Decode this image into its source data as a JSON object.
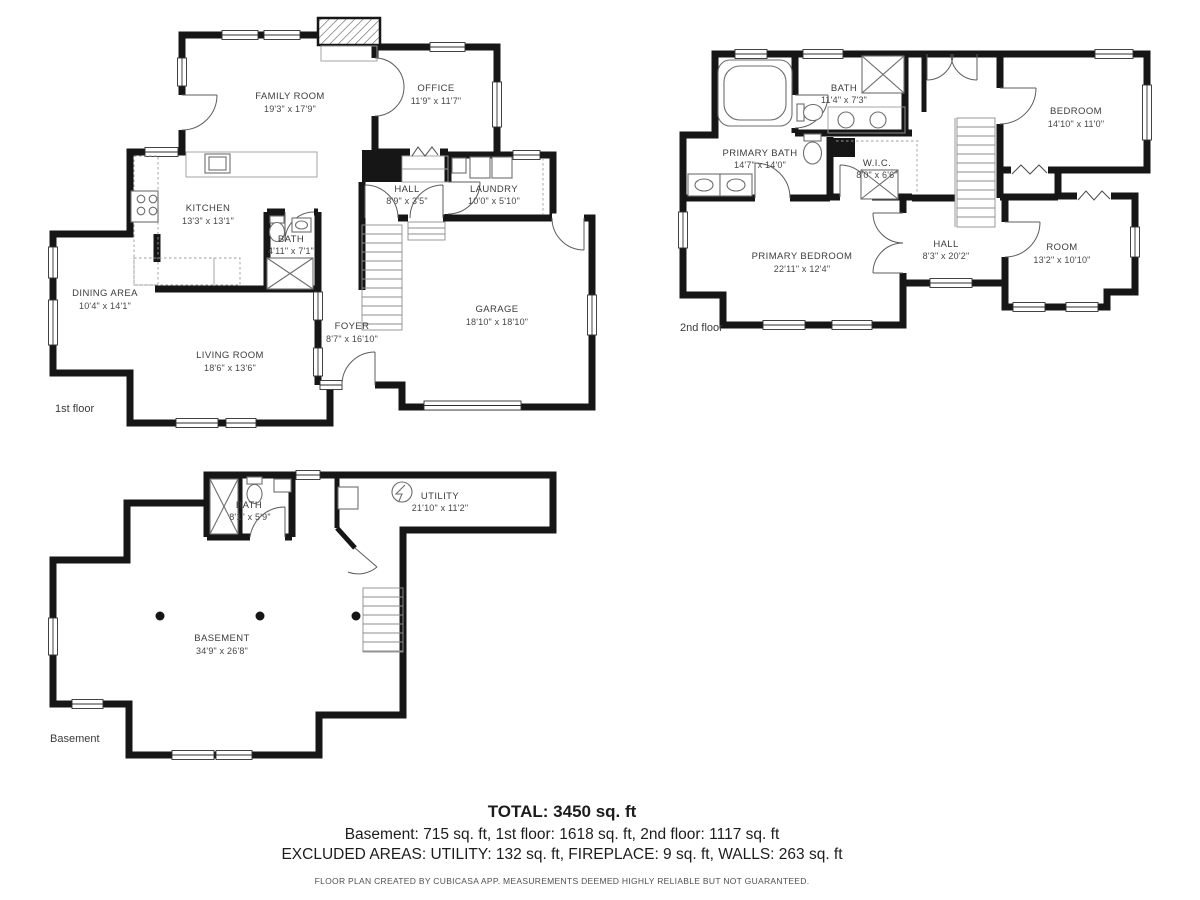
{
  "colors": {
    "wall": "#161616",
    "background": "#ffffff",
    "label_text": "#3c3c3c"
  },
  "floors": {
    "first": {
      "label": "1st floor",
      "rooms": [
        {
          "name": "FAMILY ROOM",
          "dims": "19'3\" x 17'9\""
        },
        {
          "name": "OFFICE",
          "dims": "11'9\" x 11'7\""
        },
        {
          "name": "KITCHEN",
          "dims": "13'3\" x 13'1\""
        },
        {
          "name": "HALL",
          "dims": "8'9\" x 3'5\""
        },
        {
          "name": "LAUNDRY",
          "dims": "10'0\" x 5'10\""
        },
        {
          "name": "BATH",
          "dims": "4'11\" x 7'1\""
        },
        {
          "name": "DINING AREA",
          "dims": "10'4\" x 14'1\""
        },
        {
          "name": "LIVING ROOM",
          "dims": "18'6\" x 13'6\""
        },
        {
          "name": "FOYER",
          "dims": "8'7\" x 16'10\""
        },
        {
          "name": "GARAGE",
          "dims": "18'10\" x 18'10\""
        }
      ]
    },
    "second": {
      "label": "2nd floor",
      "rooms": [
        {
          "name": "BATH",
          "dims": "11'4\" x 7'3\""
        },
        {
          "name": "BEDROOM",
          "dims": "14'10\" x 11'0\""
        },
        {
          "name": "PRIMARY BATH",
          "dims": "14'7\" x 14'0\""
        },
        {
          "name": "W.I.C.",
          "dims": "8'0\" x 6'6\""
        },
        {
          "name": "HALL",
          "dims": "8'3\" x 20'2\""
        },
        {
          "name": "PRIMARY BEDROOM",
          "dims": "22'11\" x 12'4\""
        },
        {
          "name": "ROOM",
          "dims": "13'2\" x 10'10\""
        }
      ]
    },
    "basement": {
      "label": "Basement",
      "rooms": [
        {
          "name": "BATH",
          "dims": "8'1\" x 5'9\""
        },
        {
          "name": "UTILITY",
          "dims": "21'10\" x 11'2\""
        },
        {
          "name": "BASEMENT",
          "dims": "34'9\" x 26'8\""
        }
      ]
    }
  },
  "footer": {
    "total": "TOTAL: 3450 sq. ft",
    "areas": "Basement: 715 sq. ft, 1st floor: 1618 sq. ft, 2nd floor: 1117 sq. ft",
    "excluded": "EXCLUDED AREAS: UTILITY: 132 sq. ft, FIREPLACE: 9 sq. ft, WALLS: 263 sq. ft",
    "disclaimer": "FLOOR PLAN CREATED BY CUBICASA APP. MEASUREMENTS DEEMED HIGHLY RELIABLE BUT NOT GUARANTEED."
  }
}
